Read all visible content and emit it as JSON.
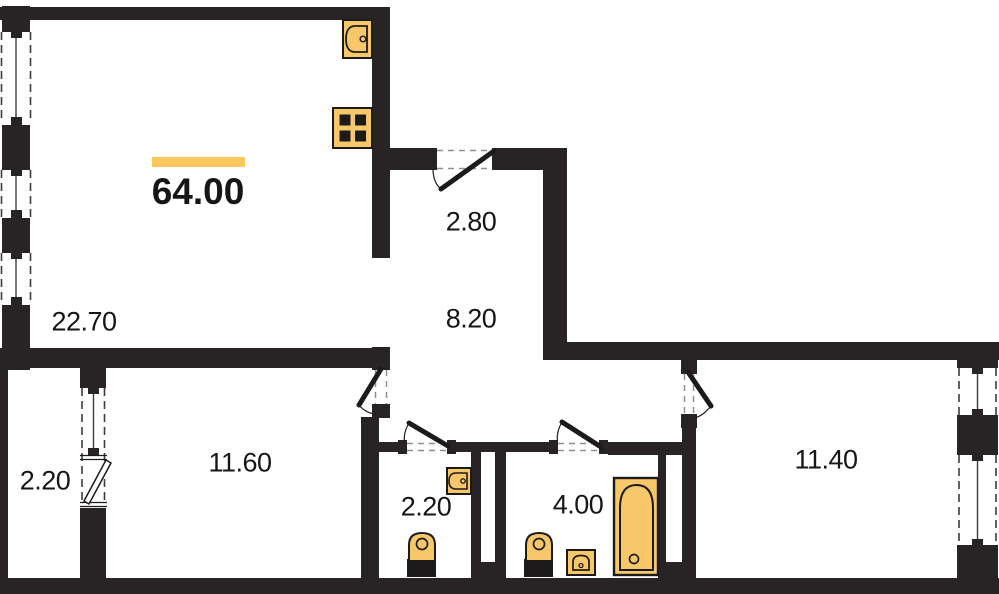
{
  "colors": {
    "wall": "#282425",
    "line": "#1d1a1b",
    "dash": "#8f8f8f",
    "windash": "#3c3c3c",
    "fixture": "#f7c869",
    "accent": "#fcc75c",
    "text": "#171515",
    "bg": "#ffffff"
  },
  "plan": {
    "type": "apartment-floor-plan",
    "total": {
      "area": "64.00"
    },
    "rooms": {
      "living": {
        "area": "22.70"
      },
      "entry": {
        "area": "2.80"
      },
      "hall": {
        "area": "8.20"
      },
      "bedroom1": {
        "area": "11.60"
      },
      "balcony": {
        "area": "2.20"
      },
      "wc": {
        "area": "2.20"
      },
      "bathroom": {
        "area": "4.00"
      },
      "bedroom2": {
        "area": "11.40"
      }
    },
    "fixtures": [
      "kitchen-sink",
      "stove",
      "wc-washbasin",
      "wc-toilet",
      "bathroom-toilet",
      "hand-basin",
      "bathtub"
    ],
    "doors": [
      "entrance-door",
      "bedroom1-door",
      "wc-door",
      "bathroom-door",
      "bedroom2-door",
      "balcony-door"
    ]
  }
}
